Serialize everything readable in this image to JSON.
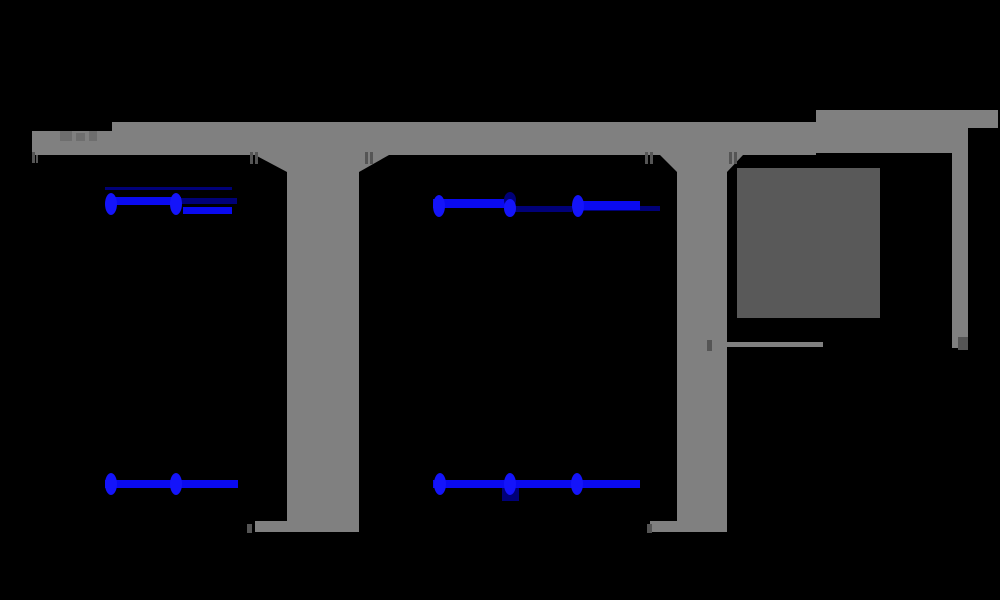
{
  "figure": {
    "title_note": "title text is rendered black-on-black (unreadable silhouette band at top)",
    "background_color": "#000000",
    "palette": {
      "concrete_gray": "#808080",
      "solid_block_gray": "#595959",
      "dim_tick_gray": "#555555",
      "smudge_gray": "#6e6e6e",
      "tendon_blue": "#0a0af0",
      "marker_blue": "#1414fa",
      "navy_blue": "#000078",
      "silhouette_black": "#000000"
    },
    "shapes": [
      {
        "name": "title-silhouette",
        "type": "rect",
        "fill": "#000000",
        "x": 32,
        "y": 62,
        "w": 958,
        "h": 50
      },
      {
        "name": "deck-left-segment",
        "type": "rect",
        "fill": "#808080",
        "x": 32,
        "y": 131,
        "w": 80,
        "h": 24
      },
      {
        "name": "deck-main-beam",
        "type": "rect",
        "fill": "#808080",
        "x": 112,
        "y": 122,
        "w": 704,
        "h": 33
      },
      {
        "name": "deck-right-lip",
        "type": "rect",
        "fill": "#808080",
        "x": 816,
        "y": 110,
        "w": 182,
        "h": 18
      },
      {
        "name": "deck-right-body",
        "type": "rect",
        "fill": "#808080",
        "x": 816,
        "y": 126,
        "w": 152,
        "h": 27
      },
      {
        "name": "pier1-shaft",
        "type": "rect",
        "fill": "#808080",
        "x": 287,
        "y": 150,
        "w": 72,
        "h": 372
      },
      {
        "name": "pier1-haunch-left",
        "type": "polygon",
        "fill": "#808080",
        "points": [
          [
            255,
            155
          ],
          [
            287,
            155
          ],
          [
            287,
            172
          ]
        ]
      },
      {
        "name": "pier1-haunch-right",
        "type": "polygon",
        "fill": "#808080",
        "points": [
          [
            359,
            155
          ],
          [
            389,
            155
          ],
          [
            359,
            172
          ]
        ]
      },
      {
        "name": "pier1-footing-line",
        "type": "rect",
        "fill": "#808080",
        "x": 255,
        "y": 521,
        "w": 104,
        "h": 11
      },
      {
        "name": "pier2-shaft",
        "type": "rect",
        "fill": "#808080",
        "x": 677,
        "y": 150,
        "w": 50,
        "h": 372
      },
      {
        "name": "pier2-haunch-left",
        "type": "polygon",
        "fill": "#808080",
        "points": [
          [
            660,
            155
          ],
          [
            677,
            155
          ],
          [
            677,
            172
          ]
        ]
      },
      {
        "name": "pier2-haunch-right",
        "type": "polygon",
        "fill": "#808080",
        "points": [
          [
            727,
            155
          ],
          [
            743,
            155
          ],
          [
            727,
            172
          ]
        ]
      },
      {
        "name": "pier2-footing-line",
        "type": "rect",
        "fill": "#808080",
        "x": 650,
        "y": 521,
        "w": 77,
        "h": 11
      },
      {
        "name": "section-edge-strip",
        "type": "rect",
        "fill": "#808080",
        "x": 952,
        "y": 128,
        "w": 16,
        "h": 220
      },
      {
        "name": "section-base-line",
        "type": "rect",
        "fill": "#808080",
        "x": 711,
        "y": 342,
        "w": 112,
        "h": 5
      },
      {
        "name": "section-solid-block",
        "type": "rect",
        "fill": "#595959",
        "x": 737,
        "y": 168,
        "w": 143,
        "h": 150
      },
      {
        "name": "deck-text-smudge-1",
        "type": "rect",
        "fill": "#6e6e6e",
        "x": 60,
        "y": 131,
        "w": 12,
        "h": 10
      },
      {
        "name": "deck-text-smudge-2",
        "type": "rect",
        "fill": "#6e6e6e",
        "x": 76,
        "y": 133,
        "w": 9,
        "h": 8
      },
      {
        "name": "deck-text-smudge-3",
        "type": "rect",
        "fill": "#6e6e6e",
        "x": 89,
        "y": 131,
        "w": 8,
        "h": 10
      },
      {
        "name": "dim-tick-left-a",
        "type": "rect",
        "fill": "#555555",
        "x": 32,
        "y": 152,
        "w": 3,
        "h": 11
      },
      {
        "name": "dim-tick-left-b",
        "type": "rect",
        "fill": "#555555",
        "x": 36,
        "y": 155,
        "w": 2,
        "h": 8
      },
      {
        "name": "dim-tick-pier1l-a",
        "type": "rect",
        "fill": "#555555",
        "x": 250,
        "y": 152,
        "w": 3,
        "h": 12
      },
      {
        "name": "dim-tick-pier1l-b",
        "type": "rect",
        "fill": "#555555",
        "x": 255,
        "y": 152,
        "w": 3,
        "h": 12
      },
      {
        "name": "dim-tick-pier1r-a",
        "type": "rect",
        "fill": "#555555",
        "x": 365,
        "y": 152,
        "w": 3,
        "h": 12
      },
      {
        "name": "dim-tick-pier1r-b",
        "type": "rect",
        "fill": "#555555",
        "x": 370,
        "y": 152,
        "w": 3,
        "h": 12
      },
      {
        "name": "dim-tick-pier2l-a",
        "type": "rect",
        "fill": "#555555",
        "x": 645,
        "y": 152,
        "w": 3,
        "h": 12
      },
      {
        "name": "dim-tick-pier2l-b",
        "type": "rect",
        "fill": "#555555",
        "x": 650,
        "y": 152,
        "w": 3,
        "h": 12
      },
      {
        "name": "dim-tick-pier2r-a",
        "type": "rect",
        "fill": "#555555",
        "x": 729,
        "y": 152,
        "w": 3,
        "h": 12
      },
      {
        "name": "dim-tick-pier2r-b",
        "type": "rect",
        "fill": "#555555",
        "x": 734,
        "y": 152,
        "w": 3,
        "h": 12
      },
      {
        "name": "dim-tick-strip-end",
        "type": "rect",
        "fill": "#555555",
        "x": 958,
        "y": 337,
        "w": 10,
        "h": 13
      },
      {
        "name": "dim-tick-baseline-left",
        "type": "rect",
        "fill": "#555555",
        "x": 707,
        "y": 340,
        "w": 5,
        "h": 11
      },
      {
        "name": "dim-tick-footing1",
        "type": "rect",
        "fill": "#555555",
        "x": 247,
        "y": 524,
        "w": 5,
        "h": 9
      },
      {
        "name": "dim-tick-footing2",
        "type": "rect",
        "fill": "#555555",
        "x": 647,
        "y": 524,
        "w": 5,
        "h": 9
      },
      {
        "name": "tendon-upper-left-navy-top",
        "type": "rect",
        "fill": "#000078",
        "x": 105,
        "y": 187,
        "w": 127,
        "h": 3
      },
      {
        "name": "tendon-upper-left-navy-right",
        "type": "rect",
        "fill": "#000078",
        "x": 181,
        "y": 198,
        "w": 56,
        "h": 6
      },
      {
        "name": "tendon-upper-left-bright-mid",
        "type": "rect",
        "fill": "#0a0af0",
        "x": 107,
        "y": 197,
        "w": 74,
        "h": 8
      },
      {
        "name": "tendon-upper-left-bright-low",
        "type": "rect",
        "fill": "#0a0af0",
        "x": 183,
        "y": 207,
        "w": 49,
        "h": 7
      },
      {
        "name": "marker-upper-left-1",
        "type": "ellipse",
        "fill": "#1414fa",
        "cx": 111,
        "cy": 204,
        "rx": 6,
        "ry": 11
      },
      {
        "name": "marker-upper-left-2",
        "type": "ellipse",
        "fill": "#1414fa",
        "cx": 176,
        "cy": 204,
        "rx": 6,
        "ry": 11
      },
      {
        "name": "tendon-upper-mid-navy-a",
        "type": "rect",
        "fill": "#000078",
        "x": 512,
        "y": 206,
        "w": 60,
        "h": 6
      },
      {
        "name": "tendon-upper-mid-navy-b",
        "type": "rect",
        "fill": "#000078",
        "x": 578,
        "y": 206,
        "w": 82,
        "h": 5
      },
      {
        "name": "tendon-upper-mid-bright-a",
        "type": "rect",
        "fill": "#0a0af0",
        "x": 433,
        "y": 199,
        "w": 72,
        "h": 9
      },
      {
        "name": "tendon-upper-mid-bright-b",
        "type": "rect",
        "fill": "#0a0af0",
        "x": 578,
        "y": 201,
        "w": 62,
        "h": 9
      },
      {
        "name": "marker-upper-mid-1",
        "type": "ellipse",
        "fill": "#1414fa",
        "cx": 439,
        "cy": 206,
        "rx": 6,
        "ry": 11
      },
      {
        "name": "marker-upper-mid-2-cap",
        "type": "ellipse",
        "fill": "#000078",
        "cx": 510,
        "cy": 200,
        "rx": 6,
        "ry": 8
      },
      {
        "name": "marker-upper-mid-2",
        "type": "ellipse",
        "fill": "#1414fa",
        "cx": 510,
        "cy": 208,
        "rx": 6,
        "ry": 9
      },
      {
        "name": "marker-upper-mid-3",
        "type": "ellipse",
        "fill": "#1414fa",
        "cx": 578,
        "cy": 206,
        "rx": 6,
        "ry": 11
      },
      {
        "name": "tendon-lower-left-line",
        "type": "rect",
        "fill": "#0a0af0",
        "x": 105,
        "y": 480,
        "w": 133,
        "h": 8
      },
      {
        "name": "marker-lower-left-1",
        "type": "ellipse",
        "fill": "#1414fa",
        "cx": 111,
        "cy": 484,
        "rx": 6,
        "ry": 11
      },
      {
        "name": "marker-lower-left-2",
        "type": "ellipse",
        "fill": "#1414fa",
        "cx": 176,
        "cy": 484,
        "rx": 6,
        "ry": 11
      },
      {
        "name": "tendon-lower-mid-navy-drop",
        "type": "rect",
        "fill": "#000078",
        "x": 502,
        "y": 488,
        "w": 17,
        "h": 13
      },
      {
        "name": "tendon-lower-mid-line",
        "type": "rect",
        "fill": "#0a0af0",
        "x": 433,
        "y": 480,
        "w": 207,
        "h": 8
      },
      {
        "name": "marker-lower-mid-1",
        "type": "ellipse",
        "fill": "#1414fa",
        "cx": 440,
        "cy": 484,
        "rx": 6,
        "ry": 11
      },
      {
        "name": "marker-lower-mid-2",
        "type": "ellipse",
        "fill": "#1414fa",
        "cx": 510,
        "cy": 484,
        "rx": 6,
        "ry": 11
      },
      {
        "name": "marker-lower-mid-3",
        "type": "ellipse",
        "fill": "#1414fa",
        "cx": 577,
        "cy": 484,
        "rx": 6,
        "ry": 11
      }
    ]
  }
}
